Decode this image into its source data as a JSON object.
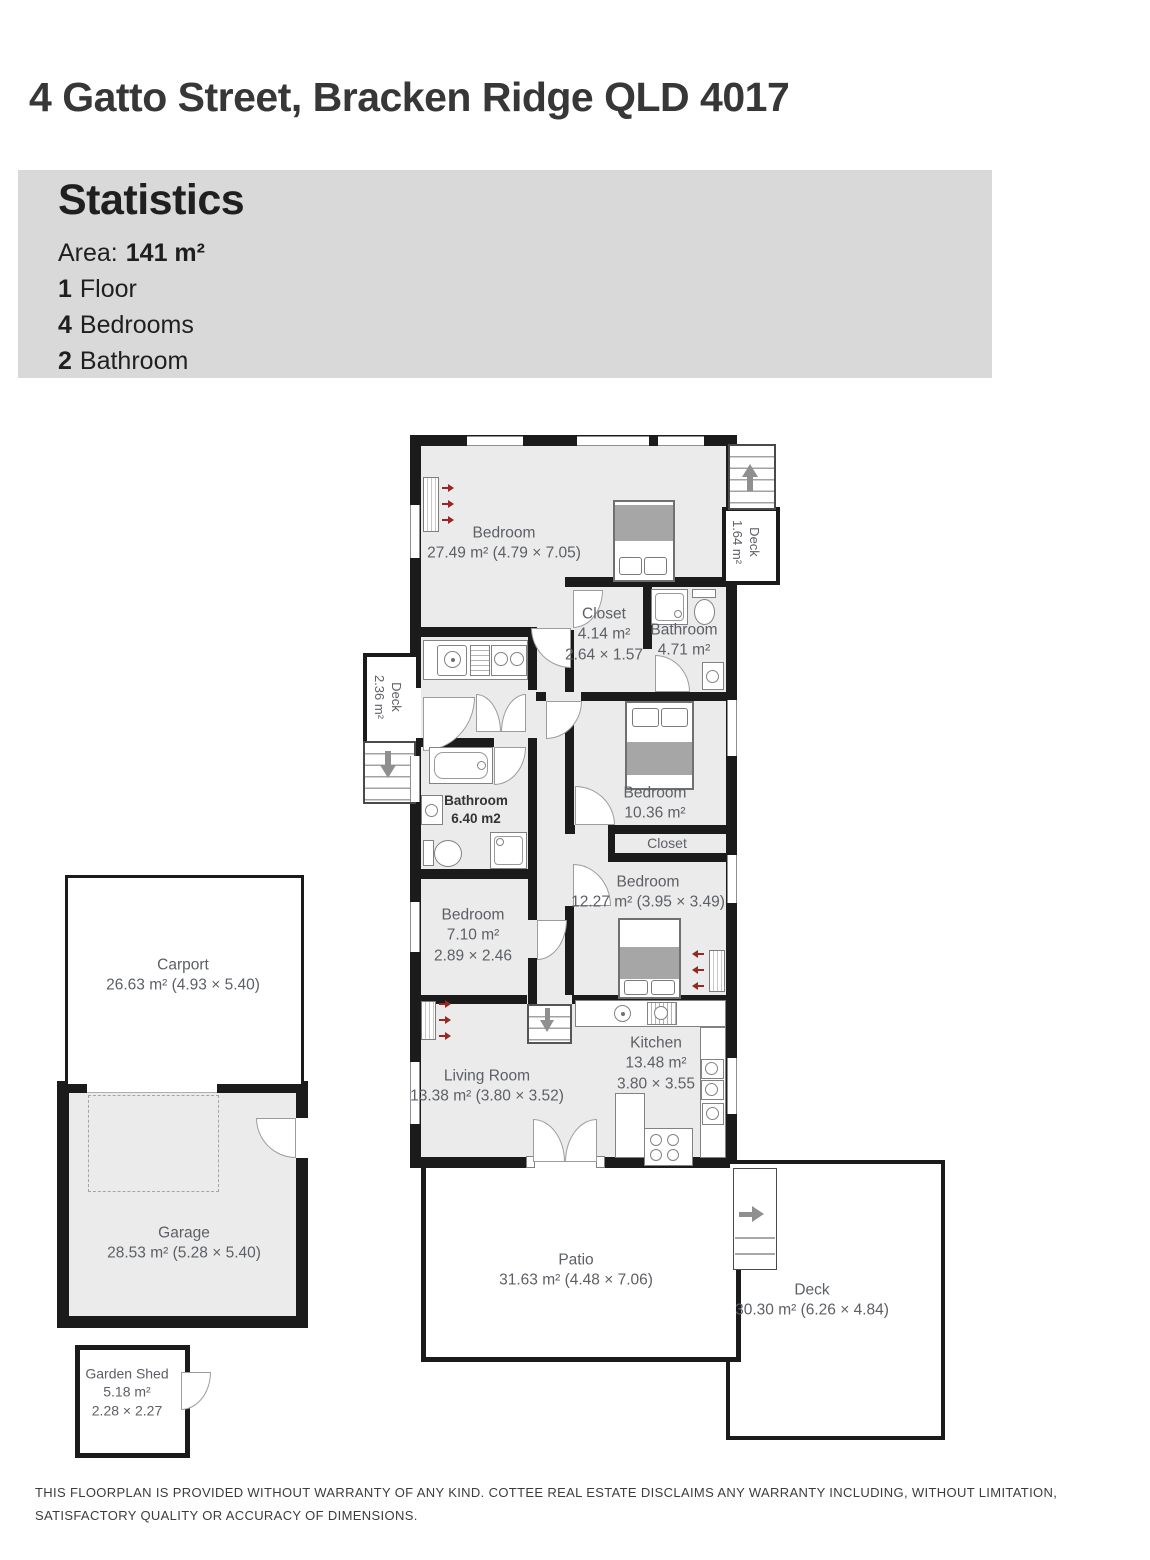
{
  "header": {
    "title": "4 Gatto Street, Bracken Ridge QLD 4017"
  },
  "statistics": {
    "heading": "Statistics",
    "area_label": "Area:",
    "area_value": "141 m²",
    "floors_value": "1",
    "floors_label": "Floor",
    "bedrooms_value": "4",
    "bedrooms_label": "Bedrooms",
    "bathrooms_value": "2",
    "bathrooms_label": "Bathroom"
  },
  "rooms": {
    "bedroom_main": {
      "name": "Bedroom",
      "area": "27.49 m² (4.79 × 7.05)"
    },
    "closet_ensuite": {
      "name": "Closet",
      "area": "4.14 m²",
      "dims": "2.64 × 1.57"
    },
    "bathroom_ensuite": {
      "name": "Bathroom",
      "area": "4.71 m²"
    },
    "deck_top": {
      "name": "Deck",
      "area": "1.64 m²"
    },
    "deck_left": {
      "name": "Deck",
      "area": "2.36 m²"
    },
    "bathroom_main": {
      "name": "Bathroom",
      "area": "6.40 m2"
    },
    "bedroom_mid": {
      "name": "Bedroom",
      "area": "10.36 m²"
    },
    "closet_hall": {
      "name": "Closet"
    },
    "bedroom_right": {
      "name": "Bedroom",
      "area": "12.27 m² (3.95 × 3.49)"
    },
    "bedroom_small": {
      "name": "Bedroom",
      "area": "7.10 m²",
      "dims": "2.89 × 2.46"
    },
    "living": {
      "name": "Living Room",
      "area": "13.38 m² (3.80 × 3.52)"
    },
    "kitchen": {
      "name": "Kitchen",
      "area": "13.48 m²",
      "dims": "3.80 × 3.55"
    },
    "patio": {
      "name": "Patio",
      "area": "31.63 m² (4.48 × 7.06)"
    },
    "deck_bottom": {
      "name": "Deck",
      "area": "30.30 m² (6.26 × 4.84)"
    },
    "carport": {
      "name": "Carport",
      "area": "26.63 m² (4.93 × 5.40)"
    },
    "garage": {
      "name": "Garage",
      "area": "28.53 m² (5.28 × 5.40)"
    },
    "garden_shed": {
      "name": "Garden Shed",
      "area": "5.18 m²",
      "dims": "2.28 × 2.27"
    }
  },
  "footer": {
    "disclaimer_line1": "THIS FLOORPLAN IS PROVIDED WITHOUT WARRANTY OF ANY KIND. COTTEE REAL ESTATE DISCLAIMS ANY WARRANTY INCLUDING, WITHOUT LIMITATION,",
    "disclaimer_line2": "SATISFACTORY QUALITY OR ACCURACY OF DIMENSIONS."
  },
  "colors": {
    "wall": "#1b1b1b",
    "floor": "#ebebeb",
    "stats_panel_bg": "#d9d9d9",
    "heater_arrow_red": "#992525",
    "stair_arrow_gray": "#8f8f8f"
  },
  "icons": {
    "stairs_up": "arrow-up-with-stem",
    "stairs_down": "arrow-down-with-stem",
    "deck_step": "arrow-right-with-stem",
    "heater_airflow": "three-red-arrows"
  }
}
